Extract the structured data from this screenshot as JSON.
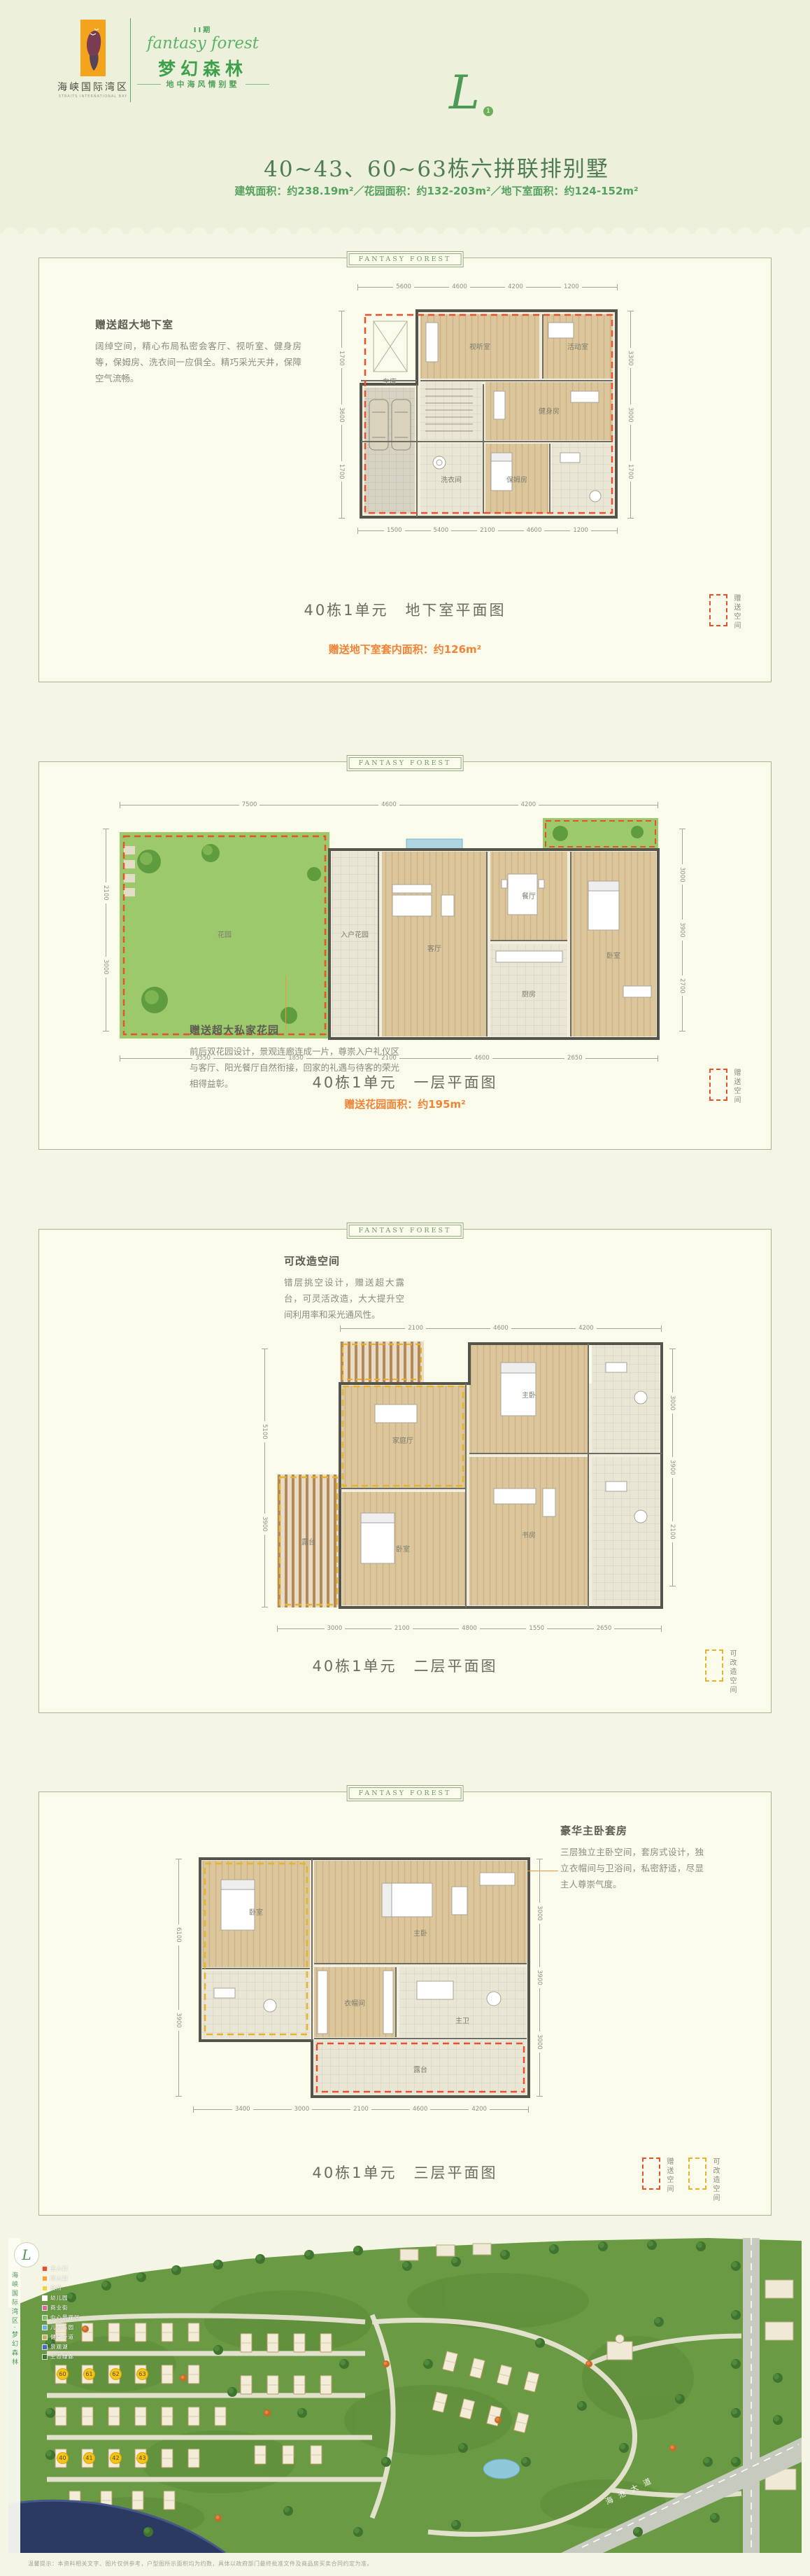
{
  "colors": {
    "brand_green": "#3da14c",
    "title_green": "#4e7d53",
    "highlight_orange": "#f08437",
    "gift_red": "#e8512e",
    "remodel_yellow": "#e5b32c",
    "page_bg": "#edf0da",
    "panel_bg": "#fbfbec"
  },
  "brand": {
    "logo_label": "海峡国际湾区",
    "logo_sub": "STRAITS INTERNATIONAL BAY",
    "phase": "II期",
    "script": "fantasy forest",
    "name_cn": "梦幻森林",
    "tagline": "地中海风情别墅",
    "unit_letter": "L",
    "unit_number": "1"
  },
  "heading": {
    "title": "40~43、60~63栋六拼联排别墅",
    "subtitle": "建筑面积：约238.19m²／花园面积：约132-203m²／地下室面积：约124-152m²"
  },
  "panel_ribbon": "FANTASY FOREST",
  "panels": {
    "basement": {
      "note_title": "赠送超大地下室",
      "note_body": "阔绰空间，精心布局私密会客厅、视听室、健身房等，保姆房、洗衣间一应俱全。精巧采光天井，保障空气流畅。",
      "caption": "40栋1单元　地下室平面图",
      "highlight": "赠送地下室套内面积：约126m²",
      "legend_gift": "赠送空间",
      "rooms": [
        "车库",
        "视听室",
        "活动室",
        "健身房",
        "保姆房",
        "洗衣间"
      ],
      "dims_top": [
        "5600",
        "4600",
        "4200",
        "1200"
      ],
      "dims_bottom": [
        "1500",
        "5400",
        "2100",
        "4600",
        "1200"
      ],
      "dims_left": [
        "1700",
        "3600",
        "1700"
      ],
      "dims_right": [
        "3300",
        "3000",
        "1700"
      ]
    },
    "first": {
      "note_title": "赠送超大私家花园",
      "note_body": "前后双花园设计，景观连廊连成一片，尊崇入户礼仪区与客厅、阳光餐厅自然衔接，回家的礼遇与待客的荣光相得益彰。",
      "caption": "40栋1单元　一层平面图",
      "highlight": "赠送花园面积：约195m²",
      "legend_gift": "赠送空间",
      "rooms": [
        "花园",
        "入户花园",
        "客厅",
        "餐厅",
        "厨房",
        "卧室"
      ],
      "dims_top": [
        "7500",
        "4600",
        "4200"
      ],
      "dims_bottom": [
        "3550",
        "1850",
        "2100",
        "4600",
        "2650"
      ],
      "dims_left": [
        "2100",
        "3000"
      ],
      "dims_right": [
        "3000",
        "3900",
        "2700"
      ]
    },
    "second": {
      "note_title": "可改造空间",
      "note_body": "错层挑空设计，赠送超大露台，可灵活改造，大大提升空间利用率和采光通风性。",
      "caption": "40栋1单元　二层平面图",
      "legend_remodel": "可改造空间",
      "rooms": [
        "露台",
        "家庭厅",
        "主卧",
        "卧室",
        "书房"
      ],
      "dims_top": [
        "2100",
        "4600",
        "4200"
      ],
      "dims_bottom": [
        "3000",
        "2100",
        "4800",
        "1550",
        "2650"
      ],
      "dims_left": [
        "5100",
        "3900"
      ],
      "dims_right": [
        "3000",
        "3900",
        "2100"
      ]
    },
    "third": {
      "note_title": "豪华主卧套房",
      "note_body": "三层独立主卧空间，套房式设计，独立衣帽间与卫浴间，私密舒适，尽显主人尊崇气度。",
      "caption": "40栋1单元　三层平面图",
      "legend_gift": "赠送空间",
      "legend_remodel": "可改造空间",
      "rooms": [
        "主卧",
        "衣帽间",
        "主卫",
        "露台",
        "卧室"
      ],
      "dims_bottom": [
        "3400",
        "3000",
        "2100",
        "4600",
        "4200"
      ],
      "dims_left": [
        "6100",
        "3900"
      ],
      "dims_right": [
        "3000",
        "3900",
        "3000"
      ]
    }
  },
  "siteplan": {
    "strip_text": "海峡国际湾区·梦幻森林",
    "badge_letter": "L",
    "road_label": "海沧大道",
    "badges": [
      "60",
      "61",
      "62",
      "63",
      "40",
      "41",
      "42",
      "43"
    ],
    "legend": [
      {
        "label": "主入口",
        "color": "#e8512e"
      },
      {
        "label": "次入口",
        "color": "#f2a33c"
      },
      {
        "label": "会所",
        "color": "#f5d23d"
      },
      {
        "label": "幼儿园",
        "color": "#ffffff"
      },
      {
        "label": "商业街",
        "color": "#d86a9c"
      },
      {
        "label": "中心景观区",
        "color": "#7fc06a"
      },
      {
        "label": "儿童乐园",
        "color": "#6ab4d8"
      },
      {
        "label": "健身步道",
        "color": "#c9b06a"
      },
      {
        "label": "景观湖",
        "color": "#4a6ab8"
      },
      {
        "label": "生态绿廊",
        "color": "#3f7330"
      }
    ]
  },
  "disclaimer": "温馨提示：本资料相关文字、图片仅供参考，户型图所示面积均为约数，具体以政府部门最终批准文件及商品房买卖合同约定为准。"
}
